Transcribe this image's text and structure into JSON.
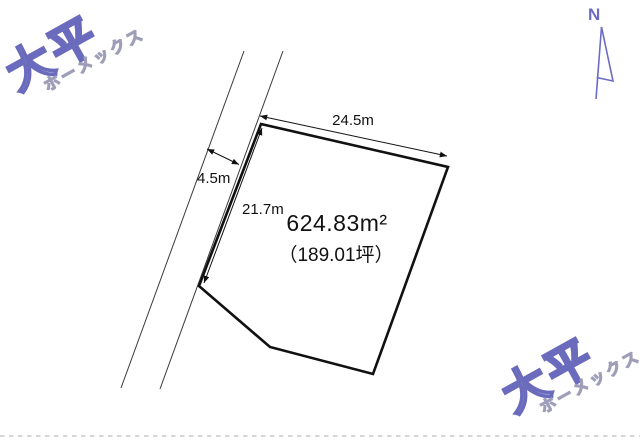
{
  "diagram": {
    "compass_label": "N",
    "area_m2": "624.83m²",
    "area_tsubo": "（189.01坪）",
    "dim_top": "24.5m",
    "dim_left": "21.7m",
    "dim_road": "4.5m"
  },
  "watermark": {
    "name": "大平",
    "subtitle": "ホーメックス"
  },
  "colors": {
    "plot_outline": "#111111",
    "road_line": "#3a3a3a",
    "dimension_line": "#111111",
    "boundary_dotted": "#c9c9c9",
    "logo_name": "#6b6bbd",
    "logo_subtitle": "#9e9eb8",
    "compass": "#6b6bc4"
  }
}
